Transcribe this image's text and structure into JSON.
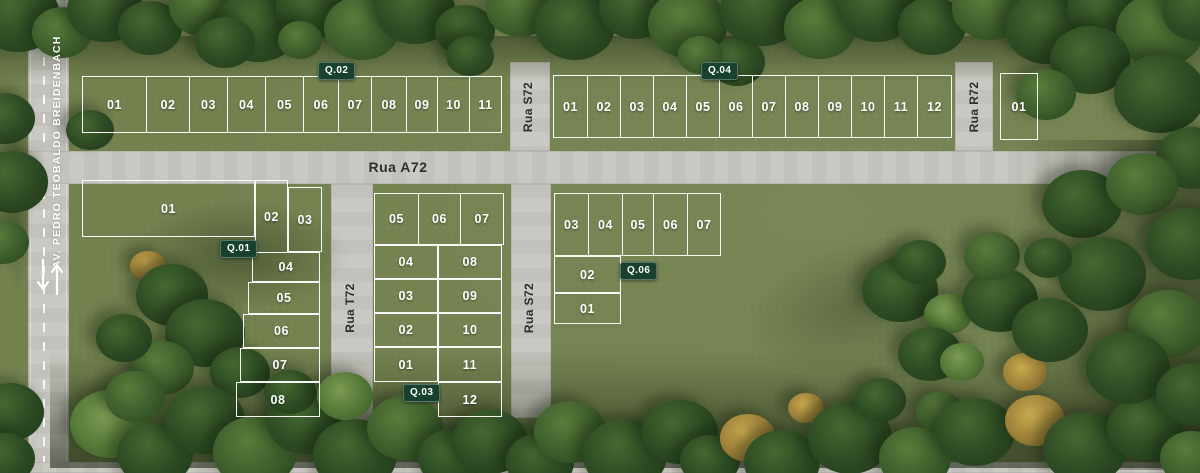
{
  "streets": {
    "avenue": "AV. PEDRO TEOBALDO BREIDENBACH",
    "a72": "Rua A72",
    "s72": "Rua S72",
    "t72": "Rua T72",
    "r72": "Rua R72"
  },
  "blocks": {
    "q01": {
      "badge": "Q.01",
      "lots": [
        "01",
        "02",
        "03",
        "04",
        "05",
        "06",
        "07",
        "08"
      ]
    },
    "q02": {
      "badge": "Q.02",
      "lots": [
        "01",
        "02",
        "03",
        "04",
        "05",
        "06",
        "07",
        "08",
        "09",
        "10",
        "11"
      ]
    },
    "q03": {
      "badge": "Q.03",
      "lots": [
        "01",
        "02",
        "03",
        "04",
        "05",
        "06",
        "07",
        "08",
        "09",
        "10",
        "11",
        "12"
      ]
    },
    "q04": {
      "badge": "Q.04",
      "lots": [
        "01",
        "02",
        "03",
        "04",
        "05",
        "06",
        "07",
        "08",
        "09",
        "10",
        "11",
        "12"
      ]
    },
    "q06": {
      "badge": "Q.06",
      "lots": [
        "01",
        "02",
        "03",
        "04",
        "05",
        "06",
        "07"
      ]
    },
    "r72_block": {
      "lots": [
        "01"
      ]
    }
  },
  "icons": {
    "two_way_arrows": "two-way-traffic-arrows"
  },
  "colors": {
    "grass": "#73814F",
    "road": "#C8C6C0",
    "tree_dark": "#2E4C24",
    "lot_line": "#FFFFFF",
    "badge_bg": "#18422D",
    "badge_text": "#FFFFFF",
    "street_label": "#2F2E29",
    "avenue_label": "#FFFFFF"
  }
}
